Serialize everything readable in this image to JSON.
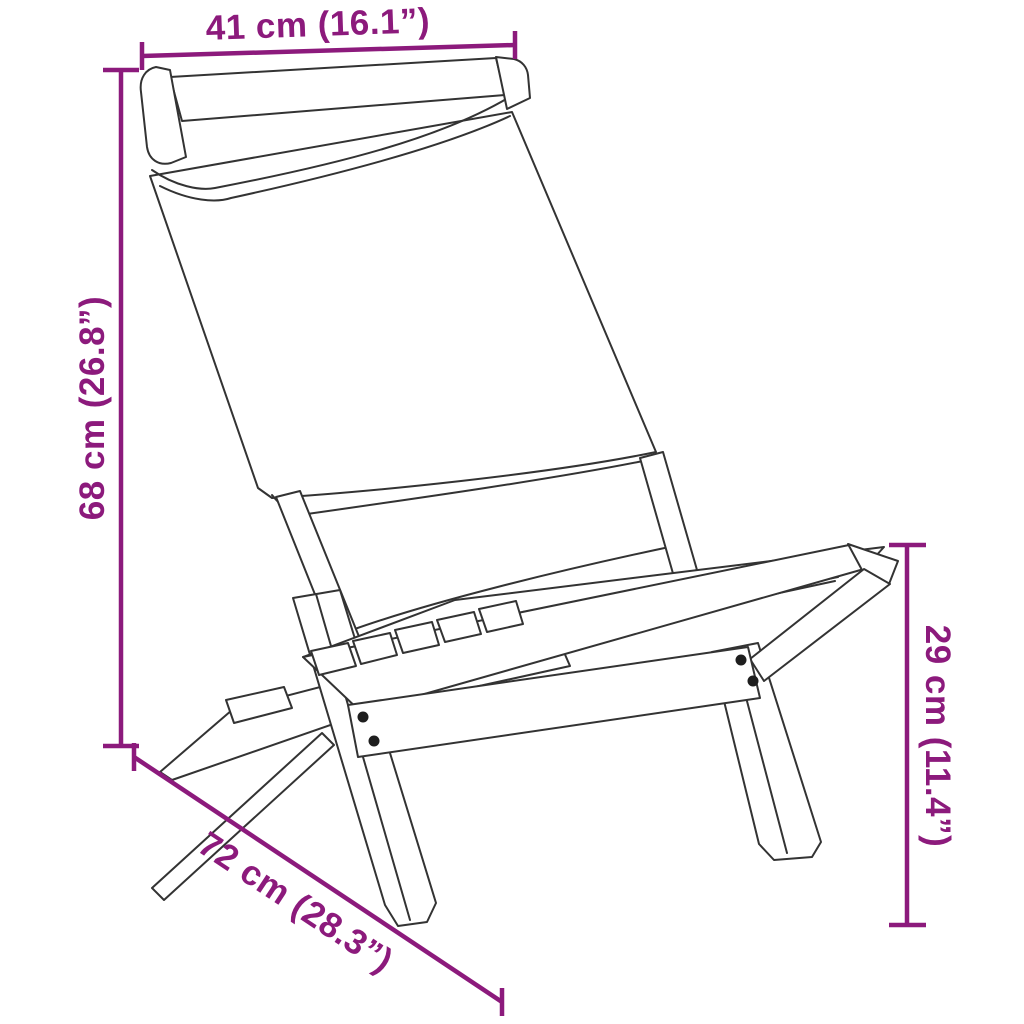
{
  "canvas": {
    "background": "#ffffff"
  },
  "diagram": {
    "subject": "folding-garden-chair-line-drawing",
    "style": {
      "accent_color": "#8C1A7C",
      "outline_color": "#333333"
    },
    "dimensions": {
      "top_width": {
        "label": "41 cm (16.1”)",
        "value_cm": "41",
        "value_inch": "16.1",
        "position": "top"
      },
      "left_height": {
        "label": "68 cm (26.8”)",
        "value_cm": "68",
        "value_inch": "26.8",
        "position": "left"
      },
      "bottom_depth": {
        "label": "72 cm (28.3”)",
        "value_cm": "72",
        "value_inch": "28.3",
        "position": "bottom-left-diagonal"
      },
      "right_seat_height": {
        "label": "29 cm (11.4”)",
        "value_cm": "29",
        "value_inch": "11.4",
        "position": "right"
      }
    }
  }
}
